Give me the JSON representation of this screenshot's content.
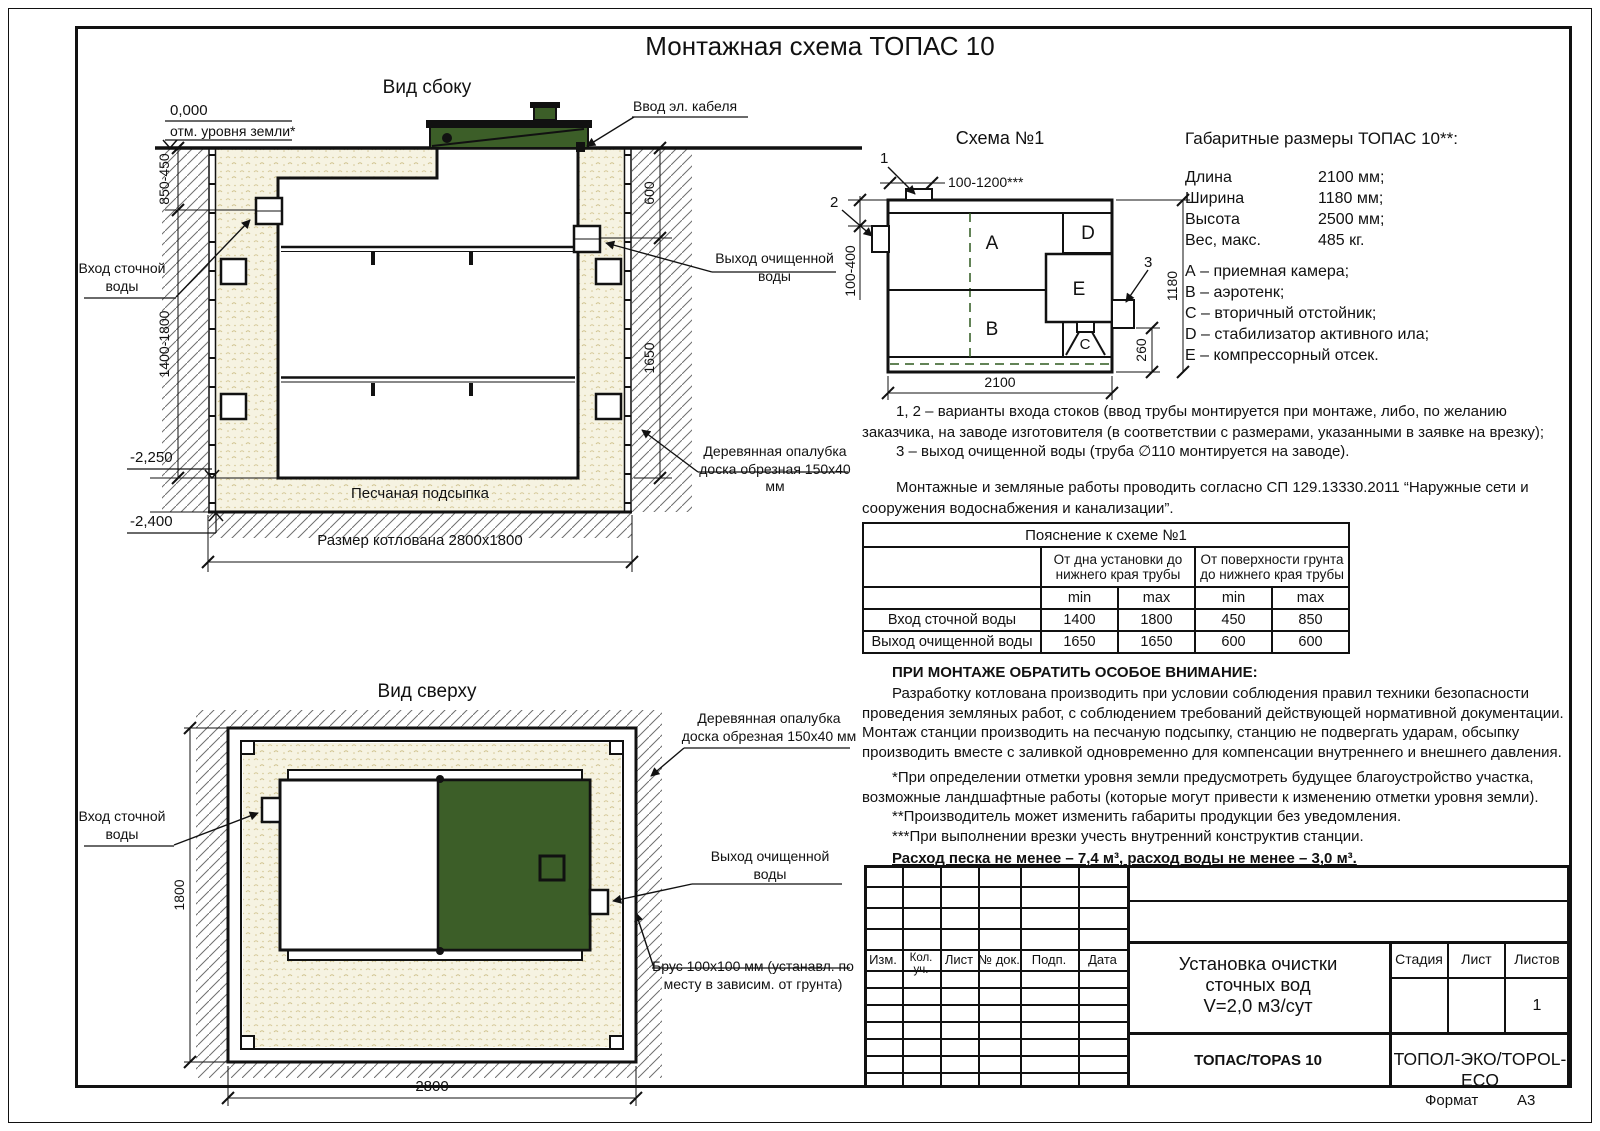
{
  "page": {
    "title": "Монтажная схема ТОПАС 10",
    "format_label": "Формат",
    "format_value": "А3"
  },
  "colors": {
    "green": "#3c5e28",
    "sand": "#f6f3e2"
  },
  "side_view": {
    "title": "Вид сбоку",
    "zero_mark": "0,000",
    "ground_note": "отм. уровня земли*",
    "dim_ground_to_inlet": "850-450",
    "dim_inlet_to_bottom": "1400-1800",
    "level_sand_top": "-2,250",
    "level_pit_bottom": "-2,400",
    "dim_ground_to_outlet": "600",
    "dim_outlet_to_bottom": "1650",
    "label_cable_entry": "Ввод эл. кабеля",
    "label_inlet": "Вход сточной\nводы",
    "label_outlet": "Выход очищенной\nводы",
    "label_formwork": "Деревянная опалубка\nдоска обрезная 150х40 мм",
    "label_sand": "Песчаная подсыпка",
    "label_pit_size": "Размер котлована 2800х1800"
  },
  "scheme": {
    "title": "Схема №1",
    "marker_1": "1",
    "marker_2": "2",
    "marker_3": "3",
    "dim_inlet_offset": "100-1200***",
    "dim_inlet_depth": "100-400",
    "dim_height": "1180",
    "dim_outlet_height": "260",
    "dim_length": "2100",
    "chamber_a": "А",
    "chamber_b": "В",
    "chamber_c": "С",
    "chamber_d": "D",
    "chamber_e": "Е"
  },
  "specs": {
    "title": "Габаритные размеры ТОПАС 10**:",
    "rows": [
      {
        "label": "Длина",
        "value": "2100 мм;"
      },
      {
        "label": "Ширина",
        "value": "1180 мм;"
      },
      {
        "label": "Высота",
        "value": "2500 мм;"
      },
      {
        "label": "Вес, макс.",
        "value": "485 кг."
      }
    ],
    "legend": [
      "А – приемная камера;",
      "В – аэротенк;",
      "С – вторичный отстойник;",
      "D – стабилизатор активного ила;",
      "Е – компрессорный отсек."
    ]
  },
  "notes": {
    "variants": "1, 2 – варианты входа стоков (ввод трубы монтируется при монтаже, либо, по желанию заказчика, на заводе изготовителя (в соответствии с размерами, указанными в заявке на врезку);",
    "outlet": "3 – выход очищенной воды (труба ∅110 монтируется на заводе).",
    "works": "Монтажные и земляные работы проводить согласно СП 129.13330.2011 “Наружные сети и сооружения водоснабжения и канализации”."
  },
  "table": {
    "title": "Пояснение к схеме №1",
    "group1": "От дна установки до\nнижнего края трубы",
    "group2": "От поверхности грунта\nдо нижнего края трубы",
    "min1": "min",
    "max1": "max",
    "min2": "min",
    "max2": "max",
    "rows": [
      {
        "name": "Вход сточной воды",
        "c1": "1400",
        "c2": "1800",
        "c3": "450",
        "c4": "850"
      },
      {
        "name": "Выход очищенной воды",
        "c1": "1650",
        "c2": "1650",
        "c3": "600",
        "c4": "600"
      }
    ]
  },
  "attention": {
    "heading": "ПРИ МОНТАЖЕ ОБРАТИТЬ ОСОБОЕ ВНИМАНИЕ:",
    "body": "Разработку котлована производить при условии соблюдения правил техники безопасности проведения земляных работ, с соблюдением требований действующей нормативной документации. Монтаж станции производить на песчаную подсыпку, станцию не подвергать ударам, обсыпку производить вместе с заливкой одновременно для компенсации внутреннего и внешнего давления.",
    "footnote1": "*При определении отметки уровня земли предусмотреть будущее благоустройство участка, возможные ландшафтные работы (которые могут привести к изменению отметки уровня земли).",
    "footnote2": "**Производитель может изменить габариты продукции без уведомления.",
    "footnote3": "***При выполнении врезки учесть внутренний конструктив станции.",
    "consumption": "Расход песка не менее – 7,4 м³, расход воды не менее – 3,0 м³."
  },
  "top_view": {
    "title": "Вид сверху",
    "dim_width": "2800",
    "dim_height": "1800",
    "label_inlet": "Вход сточной\nводы",
    "label_outlet": "Выход очищенной\nводы",
    "label_formwork": "Деревянная опалубка\nдоска обрезная 150х40 мм",
    "label_beam": "Брус 100х100 мм (устанавл. по\nместу в зависим. от грунта)"
  },
  "stamp": {
    "col_izm": "Изм.",
    "col_kol": "Кол. уч.",
    "col_list": "Лист",
    "col_doc": "№ док.",
    "col_podp": "Подп.",
    "col_data": "Дата",
    "doc_name": "Установка очистки\nсточных вод\nV=2,0 м3/сут",
    "stage_label": "Стадия",
    "sheet_label": "Лист",
    "sheets_label": "Листов",
    "sheets_value": "1",
    "product": "ТОПАС/TOPAS 10",
    "company": "ТОПОЛ-ЭКО/TOPOL-ECO"
  }
}
